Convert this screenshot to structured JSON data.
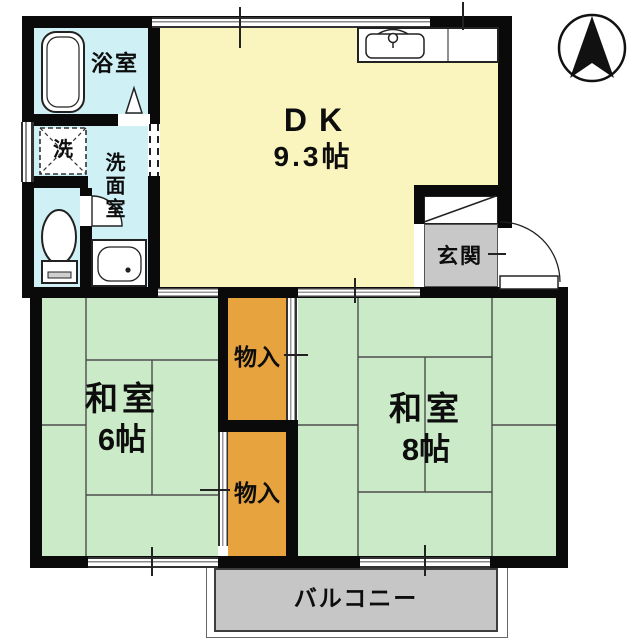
{
  "floorplan": {
    "type": "japanese-apartment-floorplan",
    "compass": {
      "icon": "north-arrow-icon",
      "direction": "N"
    },
    "colors": {
      "wet_area": "#CFF0F5",
      "dining_kitchen": "#FAF4BE",
      "tatami_room": "#CBEBC8",
      "storage": "#E6A33E",
      "entrance_floor": "#C8C8C8",
      "balcony": "#C6C6C6",
      "wall": "#0A0A0A"
    },
    "rooms": {
      "bathroom": {
        "label": "浴室"
      },
      "laundry": {
        "label": "洗"
      },
      "washroom": {
        "label": "洗面室"
      },
      "dining_kitchen": {
        "label": "DK",
        "size": "9.3帖"
      },
      "entrance": {
        "label": "玄関"
      },
      "tatami_room_left": {
        "label": "和室",
        "size": "6帖"
      },
      "tatami_room_right": {
        "label": "和室",
        "size": "8帖"
      },
      "storage_upper": {
        "label": "物入"
      },
      "storage_lower": {
        "label": "物入"
      },
      "balcony": {
        "label": "バルコニー"
      }
    },
    "fixtures": [
      "bathtub-icon",
      "washing-machine-icon",
      "toilet-icon",
      "washbasin-icon",
      "kitchen-sink-icon",
      "bathroom-door-icon",
      "toilet-door-swing-icon",
      "entrance-door-swing-icon",
      "shoe-cabinet-icon"
    ]
  }
}
